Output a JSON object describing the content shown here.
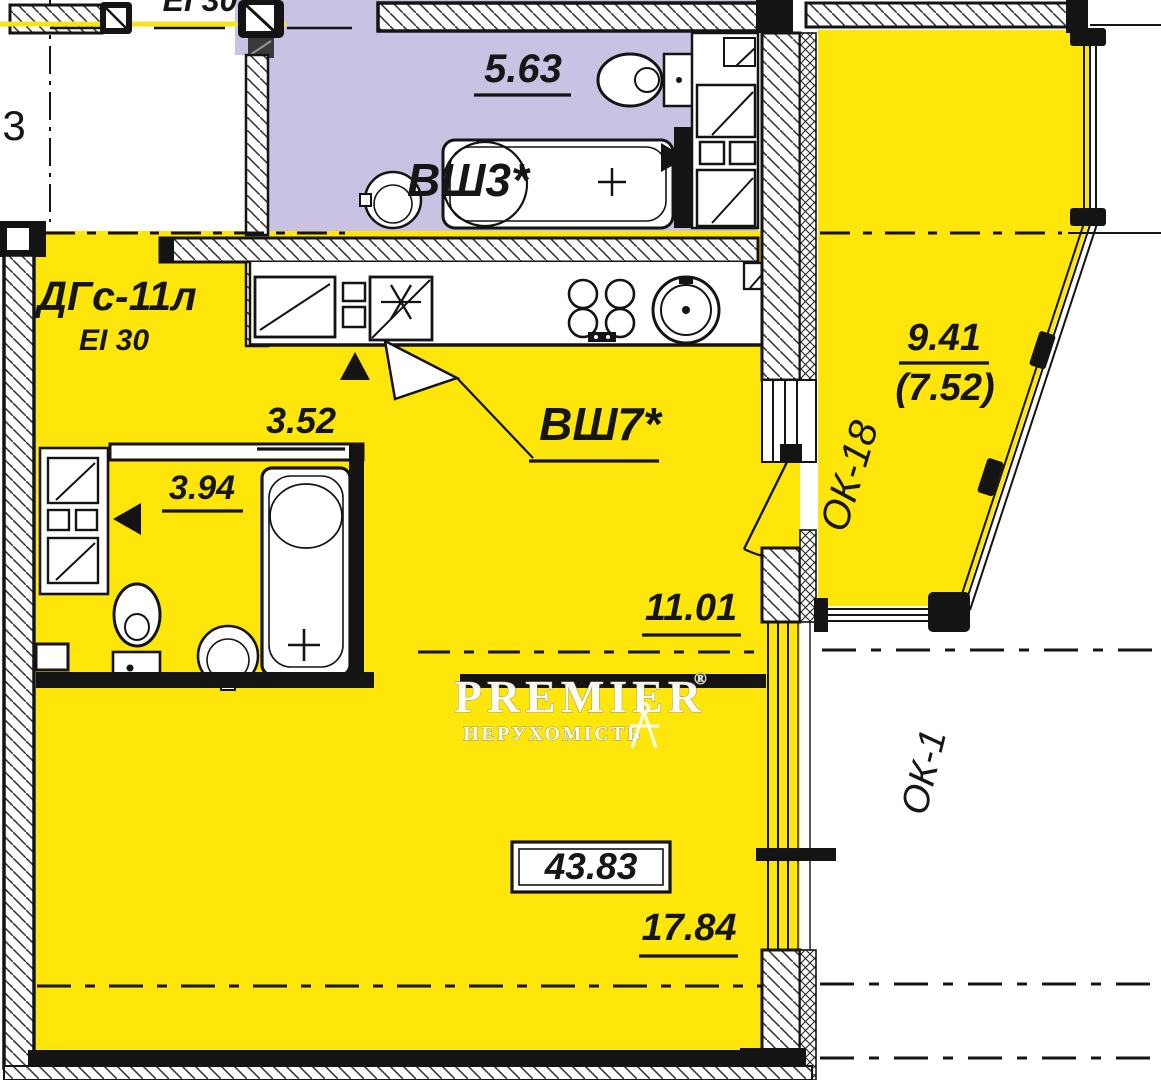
{
  "title": "Apartment floor plan",
  "colors": {
    "apartment_fill": "#ffe60a",
    "bathroom_fill": "#c9c2e2",
    "line": "#141414",
    "boundary": "#f4e41c"
  },
  "labels": {
    "axis": "3",
    "fire_top": "ЕІ 30",
    "wc_top_area": "5.63",
    "wc_top_shaft": "ВШ3*",
    "entry_door": "ДГс-11л",
    "entry_fire": "EI 30",
    "kitchen_dim": "3.52",
    "kitchen_shaft": "ВШ7*",
    "kitchen_area": "11.01",
    "bath_dim": "3.94",
    "total_area": "43.83",
    "living_dim": "17.84",
    "balcony_area": "9.41",
    "balcony_area_reduced": "(7.52)",
    "balcony_window": "ОК-18",
    "window_right": "ОК-1"
  },
  "watermark": {
    "brand": "PREMIER",
    "reg": "®",
    "tagline": "НЕРУХОМІСТЬ"
  }
}
